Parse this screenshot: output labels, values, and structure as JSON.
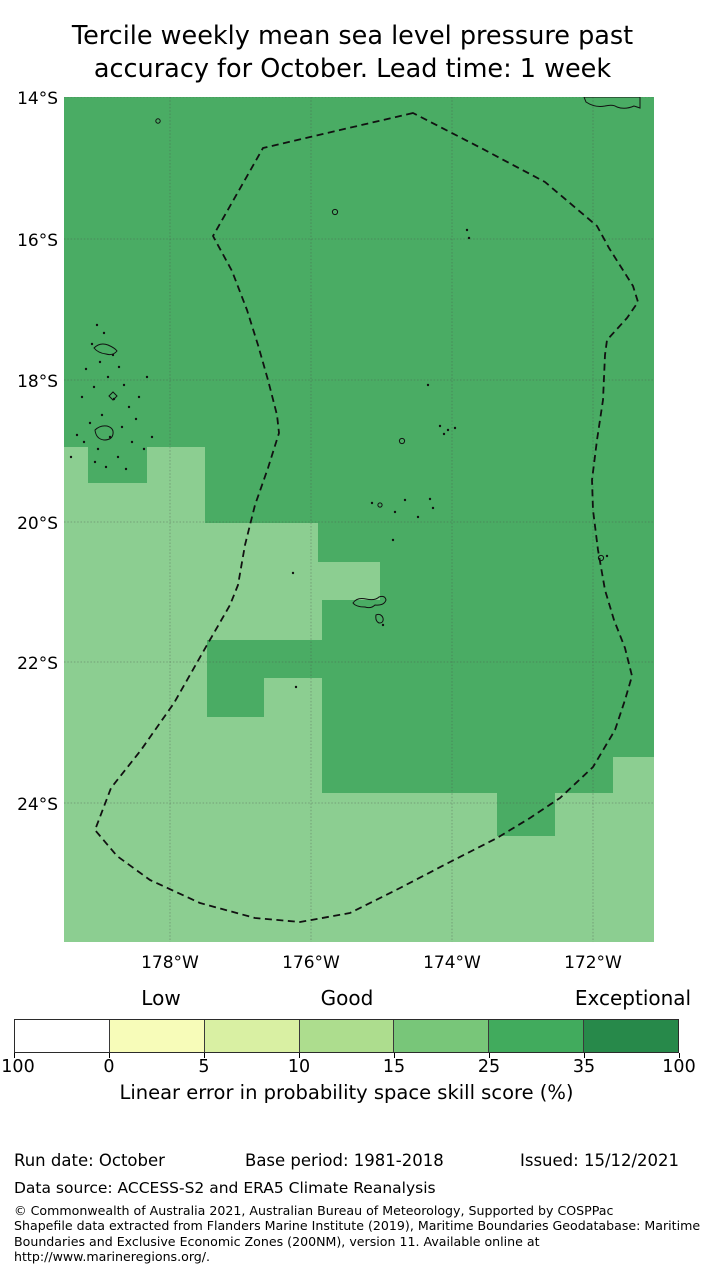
{
  "title": {
    "line1": "Tercile weekly mean sea level pressure past",
    "line2": "accuracy for October. Lead time: 1 week"
  },
  "footer": {
    "run_date": "Run date: October",
    "base_period": "Base period: 1981-2018",
    "issued": "Issued: 15/12/2021",
    "data_source": "Data source: ACCESS-S2 and ERA5 Climate Reanalysis",
    "copyright_lines": [
      "© Commonwealth of Australia 2021, Australian Bureau of Meteorology, Supported by COSPPac",
      "Shapefile data extracted from Flanders Marine Institute (2019), Maritime Boundaries Geodatabase: Maritime",
      "Boundaries and Exclusive Economic Zones (200NM), version 11. Available online at",
      "http://www.marineregions.org/."
    ]
  },
  "chart_data": {
    "type": "heatmap",
    "title": "Tercile weekly mean sea level pressure past accuracy for October. Lead time: 1 week",
    "map_area_px": {
      "left": 64,
      "top": 97,
      "width": 590,
      "height": 845
    },
    "lat_ticks": [
      {
        "label": "14°S",
        "y": 0
      },
      {
        "label": "16°S",
        "y": 142
      },
      {
        "label": "18°S",
        "y": 283
      },
      {
        "label": "20°S",
        "y": 425
      },
      {
        "label": "22°S",
        "y": 565
      },
      {
        "label": "24°S",
        "y": 706
      }
    ],
    "lon_ticks": [
      {
        "label": "178°W",
        "x": 106
      },
      {
        "label": "176°W",
        "x": 247
      },
      {
        "label": "174°W",
        "x": 388
      },
      {
        "label": "172°W",
        "x": 529
      }
    ],
    "grid": {
      "on": true,
      "color": "#4a4a4a",
      "opacity": 0.45,
      "dash": "1.5,1.8"
    },
    "regions": {
      "dark_green": {
        "color": "#4aac64",
        "skill_bin_pct": "25-35"
      },
      "light_green": {
        "color": "#8cce91",
        "skill_bin_pct": "15-25"
      }
    },
    "light_patches_px": [
      [
        0,
        350,
        24,
        36
      ],
      [
        83,
        350,
        58,
        36
      ],
      [
        0,
        386,
        141,
        40
      ],
      [
        0,
        426,
        254,
        39
      ],
      [
        0,
        465,
        316,
        38
      ],
      [
        0,
        503,
        258,
        40
      ],
      [
        0,
        543,
        143,
        38
      ],
      [
        0,
        581,
        143,
        39
      ],
      [
        200,
        581,
        58,
        39
      ],
      [
        0,
        620,
        258,
        225
      ],
      [
        258,
        739,
        332,
        106
      ],
      [
        258,
        696,
        175,
        43
      ],
      [
        491,
        696,
        58,
        43
      ],
      [
        549,
        660,
        41,
        79
      ]
    ],
    "eez_boundary_px": [
      [
        349,
        16
      ],
      [
        199,
        51
      ],
      [
        149,
        139
      ],
      [
        168,
        174
      ],
      [
        183,
        213
      ],
      [
        194,
        248
      ],
      [
        204,
        283
      ],
      [
        213,
        318
      ],
      [
        215,
        336
      ],
      [
        204,
        371
      ],
      [
        191,
        408
      ],
      [
        181,
        448
      ],
      [
        174,
        488
      ],
      [
        166,
        508
      ],
      [
        143,
        548
      ],
      [
        110,
        606
      ],
      [
        77,
        653
      ],
      [
        47,
        691
      ],
      [
        31,
        733
      ],
      [
        53,
        759
      ],
      [
        86,
        783
      ],
      [
        136,
        806
      ],
      [
        191,
        821
      ],
      [
        236,
        825
      ],
      [
        286,
        816
      ],
      [
        336,
        791
      ],
      [
        386,
        765
      ],
      [
        433,
        741
      ],
      [
        466,
        721
      ],
      [
        496,
        701
      ],
      [
        529,
        670
      ],
      [
        551,
        633
      ],
      [
        561,
        603
      ],
      [
        568,
        579
      ],
      [
        561,
        551
      ],
      [
        550,
        523
      ],
      [
        541,
        493
      ],
      [
        534,
        453
      ],
      [
        529,
        413
      ],
      [
        528,
        383
      ],
      [
        533,
        343
      ],
      [
        539,
        303
      ],
      [
        541,
        258
      ],
      [
        543,
        243
      ],
      [
        563,
        221
      ],
      [
        574,
        205
      ],
      [
        569,
        189
      ],
      [
        545,
        151
      ],
      [
        533,
        129
      ],
      [
        481,
        85
      ],
      [
        417,
        51
      ]
    ],
    "islands": {
      "dots": [
        [
          33,
          228
        ],
        [
          40,
          236
        ],
        [
          28,
          247
        ],
        [
          49,
          258
        ],
        [
          36,
          265
        ],
        [
          22,
          272
        ],
        [
          55,
          270
        ],
        [
          44,
          280
        ],
        [
          60,
          288
        ],
        [
          30,
          290
        ],
        [
          18,
          300
        ],
        [
          50,
          302
        ],
        [
          65,
          310
        ],
        [
          38,
          318
        ],
        [
          26,
          326
        ],
        [
          72,
          322
        ],
        [
          58,
          330
        ],
        [
          46,
          340
        ],
        [
          20,
          345
        ],
        [
          68,
          345
        ],
        [
          34,
          352
        ],
        [
          54,
          360
        ],
        [
          80,
          352
        ],
        [
          13,
          338
        ],
        [
          42,
          370
        ],
        [
          62,
          372
        ],
        [
          7,
          360
        ],
        [
          88,
          340
        ],
        [
          75,
          300
        ],
        [
          83,
          280
        ],
        [
          31,
          365
        ],
        [
          403,
          133
        ],
        [
          405,
          141
        ],
        [
          364,
          288
        ],
        [
          376,
          329
        ],
        [
          384,
          333
        ],
        [
          391,
          331
        ],
        [
          380,
          337
        ],
        [
          308,
          406
        ],
        [
          331,
          415
        ],
        [
          341,
          403
        ],
        [
          354,
          420
        ],
        [
          366,
          402
        ],
        [
          369,
          411
        ],
        [
          329,
          443
        ],
        [
          543,
          459
        ],
        [
          229,
          476
        ],
        [
          232,
          590
        ],
        [
          319,
          528
        ]
      ],
      "rings": [
        {
          "cx": 271,
          "cy": 115,
          "r": 2.6
        },
        {
          "cx": 338,
          "cy": 344,
          "r": 2.6
        },
        {
          "cx": 316,
          "cy": 408,
          "r": 2.1
        },
        {
          "cx": 537,
          "cy": 461,
          "r": 2.6
        },
        {
          "cx": 94,
          "cy": 24,
          "r": 2.2
        }
      ],
      "paths": [
        "M30,251 q6,-6 14,-3 q7,3 9,6 q-4,5 -11,3 q-8,-1 -12,-6 z",
        "M31,333 q5,-5 12,-4 q7,2 6,8 q-1,6 -9,6 q-8,-1 -9,-10 z",
        "M45,299 l4,-4 l4,4 l-4,4 z",
        "M289,506 q4,-6 13,-4 q9,2 13,-2 q6,-2 7,3 q-2,6 -11,5 q-4,4 -10,2 q-9,0 -12,-4 z",
        "M312,518 q5,-2 7,3 q1,5 -4,5 q-4,-2 -3,-8 z",
        "M520,0 L522,5 Q531,11 541,9 Q549,7 553,10 Q561,13 570,9 L576,11 L576,0 Z"
      ]
    },
    "colorbar": {
      "axis_label": "Linear error in probability space skill score (%)",
      "categories": [
        {
          "label": "Low",
          "cx": 161
        },
        {
          "label": "Good",
          "cx": 347
        },
        {
          "label": "Exceptional",
          "cx": 633
        }
      ],
      "segment_colors": [
        "#ffffff",
        "#f7fcb9",
        "#d9f0a3",
        "#addd8e",
        "#78c679",
        "#41ab5d",
        "#27894a"
      ],
      "edge_labels": [
        "100",
        "0",
        "5",
        "10",
        "15",
        "25",
        "35",
        "100"
      ],
      "edges_px": [
        14,
        109,
        204,
        299,
        394,
        489,
        584,
        679
      ],
      "bar_px": {
        "left": 14,
        "top": 1019,
        "width": 665,
        "height": 34
      }
    }
  }
}
